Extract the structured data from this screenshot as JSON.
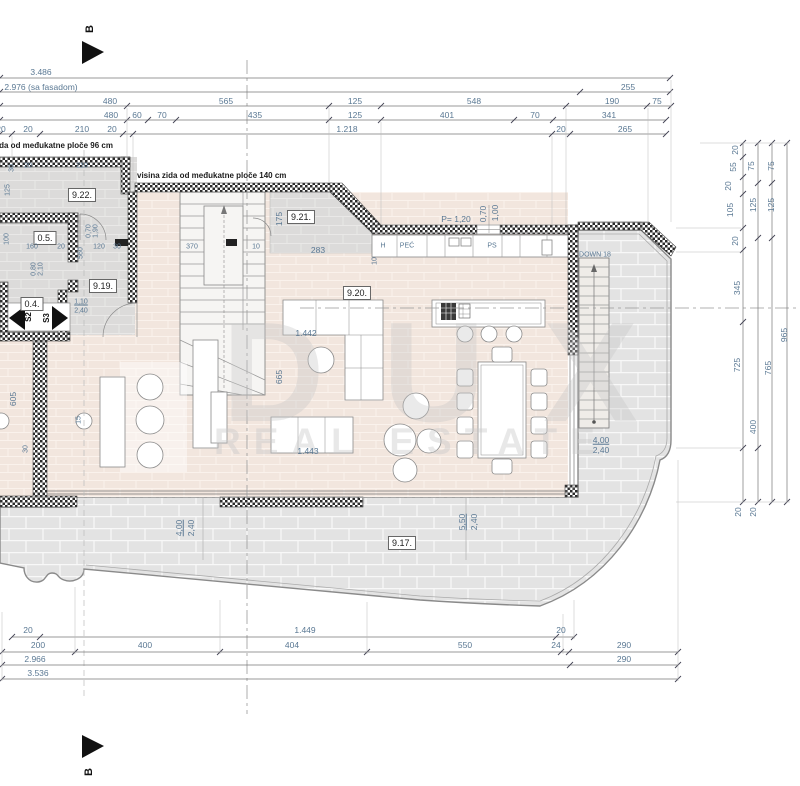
{
  "markers": {
    "top": "B",
    "bottom": "B"
  },
  "watermark": {
    "line1": "DUX",
    "line2": "REAL ESTATE"
  },
  "notes": {
    "wall96": "visina zida od međukatne ploče 96 cm",
    "wall140": "visina zida od međukatne ploče 140 cm"
  },
  "rooms": {
    "terrace": "9.17.",
    "hall": "9.19.",
    "living": "9.20.",
    "pantry": "9.21.",
    "top_room": "9.22.",
    "r04": "0.4.",
    "r05": "0.5."
  },
  "kitchen": {
    "hood": "H",
    "stove": "PEĆ",
    "dishwasher": "PS",
    "window": "P= 1,20"
  },
  "stairs": {
    "down": "DOWN 18"
  },
  "labels": [
    {
      "t": "3.486",
      "x": 41,
      "y": 72
    },
    {
      "t": "2.976 (sa fasadom)",
      "x": 41,
      "y": 87
    },
    {
      "t": "255",
      "x": 628,
      "y": 87
    },
    {
      "t": "480",
      "x": 110,
      "y": 101
    },
    {
      "t": "565",
      "x": 226,
      "y": 101
    },
    {
      "t": "125",
      "x": 355,
      "y": 101
    },
    {
      "t": "548",
      "x": 474,
      "y": 101
    },
    {
      "t": "190",
      "x": 612,
      "y": 101
    },
    {
      "t": "75",
      "x": 657,
      "y": 101
    },
    {
      "t": "480",
      "x": 111,
      "y": 115
    },
    {
      "t": "60",
      "x": 137,
      "y": 115
    },
    {
      "t": "70",
      "x": 162,
      "y": 115
    },
    {
      "t": "435",
      "x": 255,
      "y": 115
    },
    {
      "t": "125",
      "x": 355,
      "y": 115
    },
    {
      "t": "401",
      "x": 447,
      "y": 115
    },
    {
      "t": "70",
      "x": 535,
      "y": 115
    },
    {
      "t": "341",
      "x": 609,
      "y": 115
    },
    {
      "t": "20",
      "x": 1,
      "y": 129
    },
    {
      "t": "20",
      "x": 28,
      "y": 129
    },
    {
      "t": "210",
      "x": 82,
      "y": 129
    },
    {
      "t": "20",
      "x": 112,
      "y": 129
    },
    {
      "t": "1.218",
      "x": 347,
      "y": 129
    },
    {
      "t": "20",
      "x": 561,
      "y": 129
    },
    {
      "t": "265",
      "x": 625,
      "y": 129
    },
    {
      "t": "20",
      "x": 28,
      "y": 630
    },
    {
      "t": "1.449",
      "x": 305,
      "y": 630
    },
    {
      "t": "20",
      "x": 561,
      "y": 630
    },
    {
      "t": "200",
      "x": 38,
      "y": 645
    },
    {
      "t": "400",
      "x": 145,
      "y": 645
    },
    {
      "t": "404",
      "x": 292,
      "y": 645
    },
    {
      "t": "550",
      "x": 465,
      "y": 645
    },
    {
      "t": "24",
      "x": 556,
      "y": 645
    },
    {
      "t": "290",
      "x": 624,
      "y": 645
    },
    {
      "t": "2.966",
      "x": 35,
      "y": 659
    },
    {
      "t": "290",
      "x": 624,
      "y": 659
    },
    {
      "t": "3.536",
      "x": 38,
      "y": 673
    },
    {
      "t": "20",
      "x": 735,
      "y": 150,
      "r": -90
    },
    {
      "t": "55",
      "x": 733,
      "y": 167,
      "r": -90
    },
    {
      "t": "20",
      "x": 728,
      "y": 186,
      "r": -90
    },
    {
      "t": "105",
      "x": 730,
      "y": 210,
      "r": -90
    },
    {
      "t": "20",
      "x": 735,
      "y": 241,
      "r": -90
    },
    {
      "t": "345",
      "x": 737,
      "y": 288,
      "r": -90
    },
    {
      "t": "725",
      "x": 737,
      "y": 365,
      "r": -90
    },
    {
      "t": "20",
      "x": 738,
      "y": 512,
      "r": -90
    },
    {
      "t": "75",
      "x": 751,
      "y": 166,
      "r": -90
    },
    {
      "t": "125",
      "x": 753,
      "y": 205,
      "r": -90
    },
    {
      "t": "400",
      "x": 753,
      "y": 427,
      "r": -90
    },
    {
      "t": "20",
      "x": 753,
      "y": 512,
      "r": -90
    },
    {
      "t": "75",
      "x": 771,
      "y": 166,
      "r": -90
    },
    {
      "t": "125",
      "x": 771,
      "y": 205,
      "r": -90
    },
    {
      "t": "765",
      "x": 768,
      "y": 368,
      "r": -90
    },
    {
      "t": "965",
      "x": 784,
      "y": 335,
      "r": -90
    },
    {
      "t": "visina zida od međukatne ploče 96 cm",
      "x": -32,
      "y": 146,
      "a": "l",
      "cls": "note"
    },
    {
      "t": "visina zida od međukatne ploče 140 cm",
      "x": 137,
      "y": 176,
      "a": "l",
      "cls": "note"
    },
    {
      "t": "9.22.",
      "x": 82,
      "y": 195,
      "cls": "room",
      "n": "room-label-922"
    },
    {
      "t": "0.5.",
      "x": 45,
      "y": 238,
      "cls": "room",
      "n": "room-label-05"
    },
    {
      "t": "0.4.",
      "x": 32,
      "y": 304,
      "cls": "room",
      "n": "room-label-04"
    },
    {
      "t": "9.19.",
      "x": 103,
      "y": 286,
      "cls": "room",
      "n": "room-label-919"
    },
    {
      "t": "9.21.",
      "x": 301,
      "y": 217,
      "cls": "room",
      "n": "room-label-921"
    },
    {
      "t": "9.20.",
      "x": 357,
      "y": 293,
      "cls": "room",
      "n": "room-label-920"
    },
    {
      "t": "9.17.",
      "x": 402,
      "y": 543,
      "cls": "room",
      "n": "room-label-917"
    },
    {
      "t": "S2",
      "x": 29,
      "y": 317,
      "r": -90,
      "cls": "s",
      "n": "shutter-s2-label"
    },
    {
      "t": "S3",
      "x": 47,
      "y": 318,
      "r": -90,
      "cls": "s",
      "n": "shutter-s3-label"
    },
    {
      "t": "H",
      "x": 383,
      "y": 246,
      "cls": "tiny",
      "n": "kitchen-hood-label"
    },
    {
      "t": "PEĆ",
      "x": 407,
      "y": 246,
      "cls": "tiny",
      "n": "kitchen-stove-label"
    },
    {
      "t": "PS",
      "x": 492,
      "y": 246,
      "cls": "tiny",
      "n": "kitchen-ps-label"
    },
    {
      "t": "P= 1,20",
      "x": 456,
      "y": 219
    },
    {
      "t": "0,70",
      "x": 483,
      "y": 214,
      "r": -90
    },
    {
      "t": "1,00",
      "x": 495,
      "y": 213,
      "r": -90
    },
    {
      "t": "DOWN 18",
      "x": 595,
      "y": 255,
      "cls": "tiny",
      "n": "down-stairs-label"
    },
    {
      "t": "370",
      "x": 192,
      "y": 247,
      "cls": "tiny"
    },
    {
      "t": "10",
      "x": 256,
      "y": 247,
      "cls": "tiny"
    },
    {
      "t": "283",
      "x": 318,
      "y": 250
    },
    {
      "t": "175",
      "x": 279,
      "y": 219,
      "r": -90
    },
    {
      "t": "10",
      "x": 375,
      "y": 261,
      "r": -90,
      "cls": "tiny"
    },
    {
      "t": "4,00",
      "x": 601,
      "y": 440,
      "cls": "dimu"
    },
    {
      "t": "2,40",
      "x": 601,
      "y": 450
    },
    {
      "t": "4,00",
      "x": 179,
      "y": 528,
      "r": -90,
      "cls": "dimu"
    },
    {
      "t": "2,40",
      "x": 191,
      "y": 528,
      "r": -90
    },
    {
      "t": "5,50",
      "x": 462,
      "y": 522,
      "r": -90,
      "cls": "dimu"
    },
    {
      "t": "2,40",
      "x": 474,
      "y": 522,
      "r": -90
    },
    {
      "t": "1.442",
      "x": 306,
      "y": 333
    },
    {
      "t": "1.443",
      "x": 308,
      "y": 451
    },
    {
      "t": "665",
      "x": 279,
      "y": 377,
      "r": -90
    },
    {
      "t": "605",
      "x": 13,
      "y": 399,
      "r": -90
    },
    {
      "t": "30",
      "x": 26,
      "y": 449,
      "r": -90,
      "cls": "tiny"
    },
    {
      "t": "15",
      "x": 79,
      "y": 420,
      "r": -90,
      "cls": "tiny"
    },
    {
      "t": "30",
      "x": 12,
      "y": 168,
      "r": -90,
      "cls": "tiny"
    },
    {
      "t": "20",
      "x": 28,
      "y": 166,
      "cls": "tiny"
    },
    {
      "t": "210",
      "x": 82,
      "y": 166,
      "cls": "tiny"
    },
    {
      "t": "125",
      "x": 8,
      "y": 190,
      "r": -90,
      "cls": "tiny"
    },
    {
      "t": "160",
      "x": 32,
      "y": 247,
      "cls": "tiny"
    },
    {
      "t": "20",
      "x": 61,
      "y": 247,
      "cls": "tiny"
    },
    {
      "t": "120",
      "x": 99,
      "y": 247,
      "cls": "tiny"
    },
    {
      "t": "30",
      "x": 117,
      "y": 247,
      "cls": "tiny"
    },
    {
      "t": "560",
      "x": 81,
      "y": 253,
      "r": -90,
      "cls": "tiny"
    },
    {
      "t": "100",
      "x": 7,
      "y": 239,
      "r": -90,
      "cls": "tiny"
    },
    {
      "t": "0,80",
      "x": 34,
      "y": 269,
      "r": -90,
      "cls": "tiny"
    },
    {
      "t": "2,10",
      "x": 41,
      "y": 269,
      "r": -90,
      "cls": "tiny"
    },
    {
      "t": "0,70",
      "x": 89,
      "y": 231,
      "r": -90,
      "cls": "tiny"
    },
    {
      "t": "1,90",
      "x": 96,
      "y": 231,
      "r": -90,
      "cls": "tiny"
    },
    {
      "t": "1,10",
      "x": 81,
      "y": 302,
      "cls": "tinyu"
    },
    {
      "t": "2,40",
      "x": 81,
      "y": 311,
      "cls": "tiny"
    }
  ]
}
